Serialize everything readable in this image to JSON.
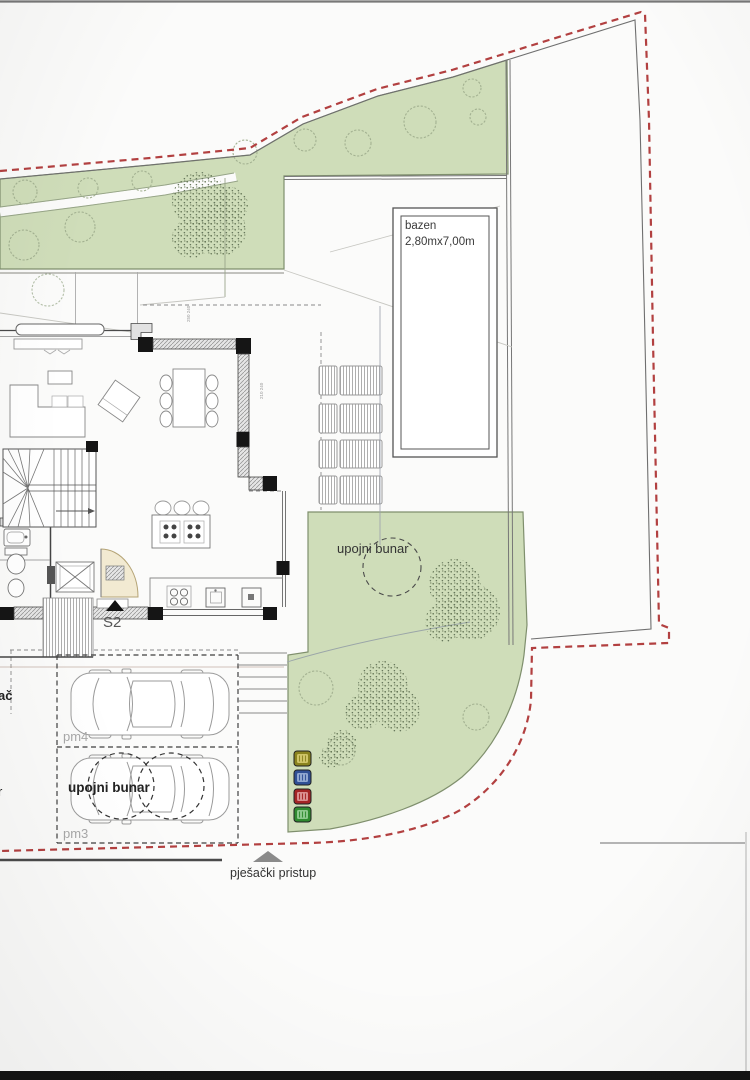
{
  "meta": {
    "type": "architectural site plan photo"
  },
  "labels": {
    "pool_name": "bazen",
    "pool_size": "2,80mx7,00m",
    "soakaway_garden": "upojni bunar",
    "soakaway_parking": "upojni bunar",
    "parking_stall_1": "pm4",
    "parking_stall_2": "pm3",
    "entrance_marker": "S2",
    "pedestrian_access": "pješački pristup",
    "edge_fragment_top": "ač",
    "edge_fragment_bottom": "r",
    "dim_a": "250 240",
    "dim_b": "210 240"
  },
  "colors": {
    "green_fill": "#cfddb9",
    "green_edge": "#7f8f6d",
    "boundary_red": "#b24040",
    "parcel_line": "#6f6f6f",
    "wall": "#4a4a4a",
    "column": "#151515",
    "furniture_line": "#999999",
    "door_fill": "#f2ead2",
    "door_edge": "#b5a476"
  },
  "bins": [
    {
      "name": "yellow-bin",
      "color": "#8a831f",
      "inner": "#cfc468"
    },
    {
      "name": "blue-bin",
      "color": "#2f4f95",
      "inner": "#8fa6d0"
    },
    {
      "name": "red-bin",
      "color": "#a42525",
      "inner": "#d98f8f"
    },
    {
      "name": "green-bin",
      "color": "#2f8a2f",
      "inner": "#8cc88c"
    }
  ]
}
